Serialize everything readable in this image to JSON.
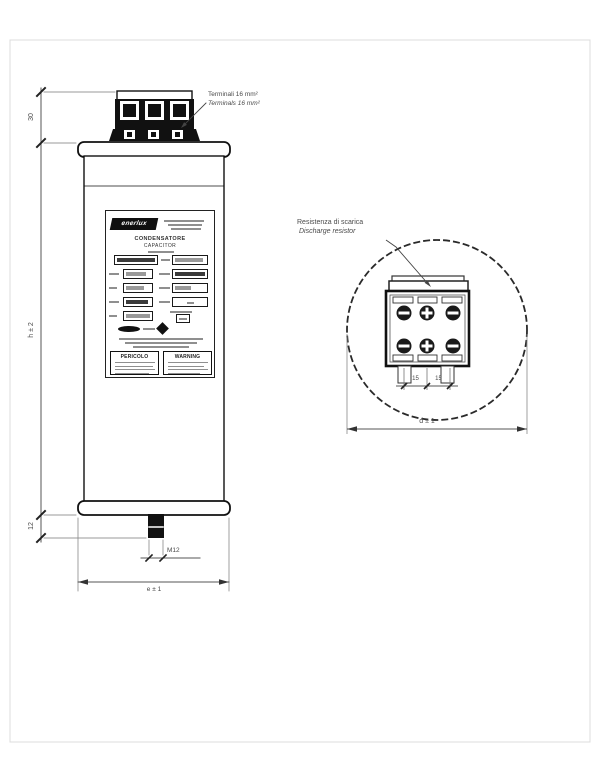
{
  "annotations": {
    "terminals_it": "Terminali 16 mm²",
    "terminals_en": "Terminals 16 mm²",
    "discharge_it": "Resistenza di scarica",
    "discharge_en": "Discharge resistor"
  },
  "dims": {
    "terminal_height": "30",
    "case_height": "h ± 2",
    "stud_length": "12",
    "stud_thread": "M12",
    "case_width": "e ± 1",
    "diameter": "d ± 1",
    "pitch_left": "15",
    "pitch_right": "15"
  },
  "nameplate": {
    "brand": "enerlux",
    "title_it": "CONDENSATORE",
    "title_en": "CAPACITOR",
    "warning_it": "PERICOLO",
    "warning_en": "WARNING"
  },
  "colors": {
    "outline": "#1c1c1c",
    "dimension": "#555555",
    "text": "#4a4a4a"
  }
}
